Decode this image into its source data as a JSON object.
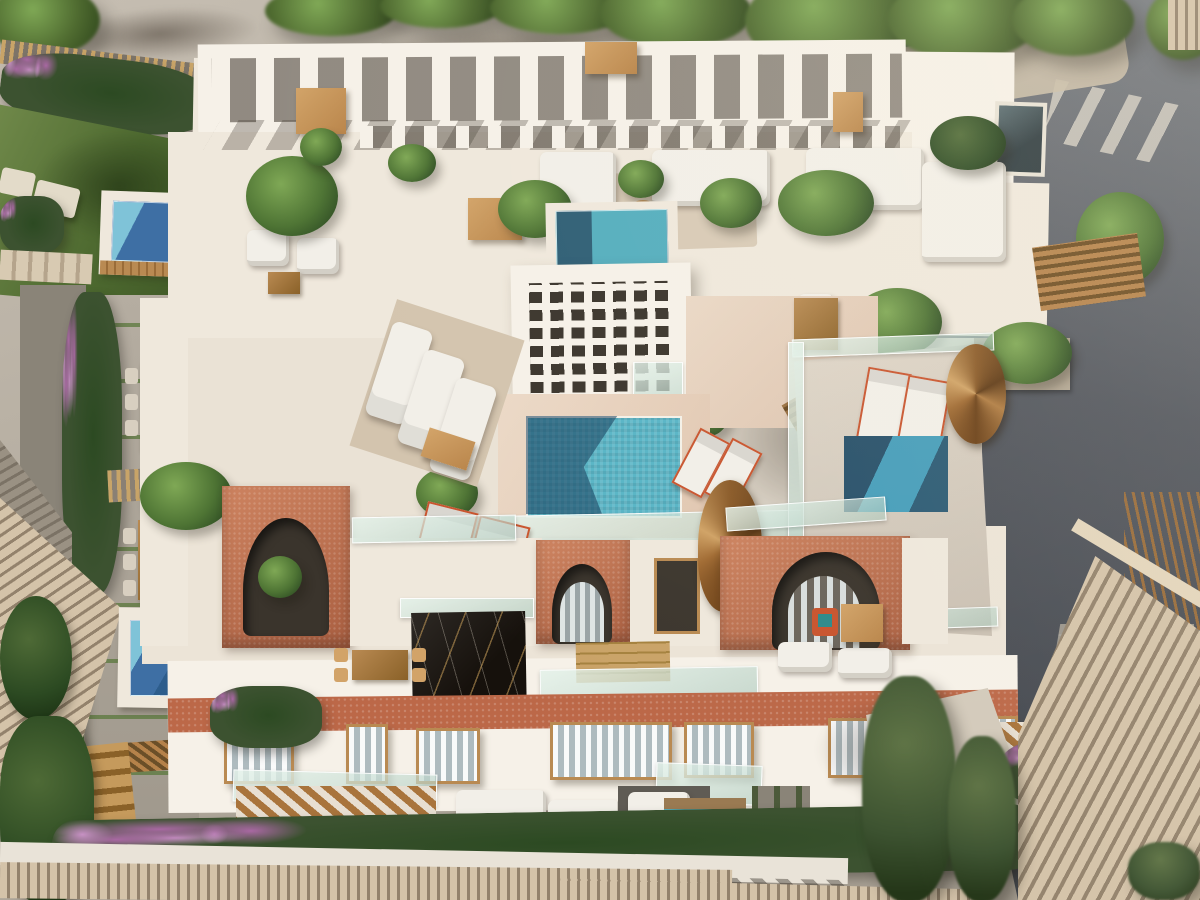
{
  "scene": {
    "type": "architectural-3d-render",
    "view": "aerial top-down",
    "subject": "Mediterranean residential building with rooftop terraces, plunge pools, pergolas, arched terracotta facades and gardens",
    "no_text_visible": true
  },
  "palette": {
    "street": "#b4ac9f",
    "road": "#4d515a",
    "wall": "#efe8dc",
    "wallbright": "#f6f1e8",
    "terra": "#cd8360",
    "terradark": "#aa5f41",
    "roofband": "#bc6848",
    "wood": "#b98a52",
    "wooddark": "#8a6128",
    "tan": "#d2a368",
    "poolblue": "#57b4c6",
    "pooldeep": "#2b5f7f",
    "poolnavy": "#27506a",
    "poolroyal": "#3e6fa4",
    "glasshi": "rgba(228,242,234,0.85)",
    "glasslo": "rgba(170,200,188,0.60)",
    "leaf": "#4e7434",
    "leafdark": "#2c4a22",
    "leaflight": "#7fa855",
    "lawnlight": "#70894a",
    "lawndark": "#3f5826",
    "bloom": "#a868a2",
    "bloomlight": "#c791c4",
    "tile": "#d4c3a9",
    "tilegap": "#93826c",
    "marble": "#16110c",
    "vein": "rgba(202,160,90,0.55)",
    "sofa": "#f2efe8",
    "rug": "#d8cab6",
    "orange": "#c8542e",
    "pot": "#b3a794",
    "dark": "#3a342c",
    "curtain": "#aeb9bd",
    "deck": "#ecd9c7"
  },
  "objects": {
    "pools": 7,
    "rooftop_colonnade": true,
    "breeze_block_lattice": true,
    "terracotta_arches": 4,
    "spiral_staircases": 2,
    "sun_loungers": 5,
    "orange_deck_chairs": 6,
    "bougainvillea_hedges": 4,
    "black_marble_shaft": true,
    "streets": [
      "light pavement top-left",
      "dark asphalt right with crosswalk"
    ]
  }
}
